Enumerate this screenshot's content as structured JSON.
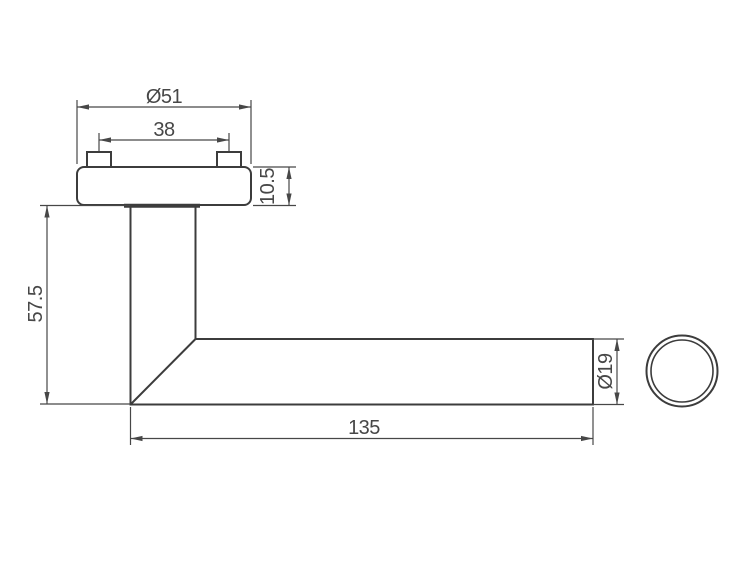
{
  "drawing": {
    "background_color": "#ffffff",
    "outline_color": "#3c3c3c",
    "dimension_color": "#474747",
    "dimensions": {
      "rose_diameter": "Ø51",
      "pin_spacing": "38",
      "rose_thickness": "10.5",
      "handle_height": "57.5",
      "lever_length": "135",
      "tube_diameter": "Ø19"
    }
  }
}
